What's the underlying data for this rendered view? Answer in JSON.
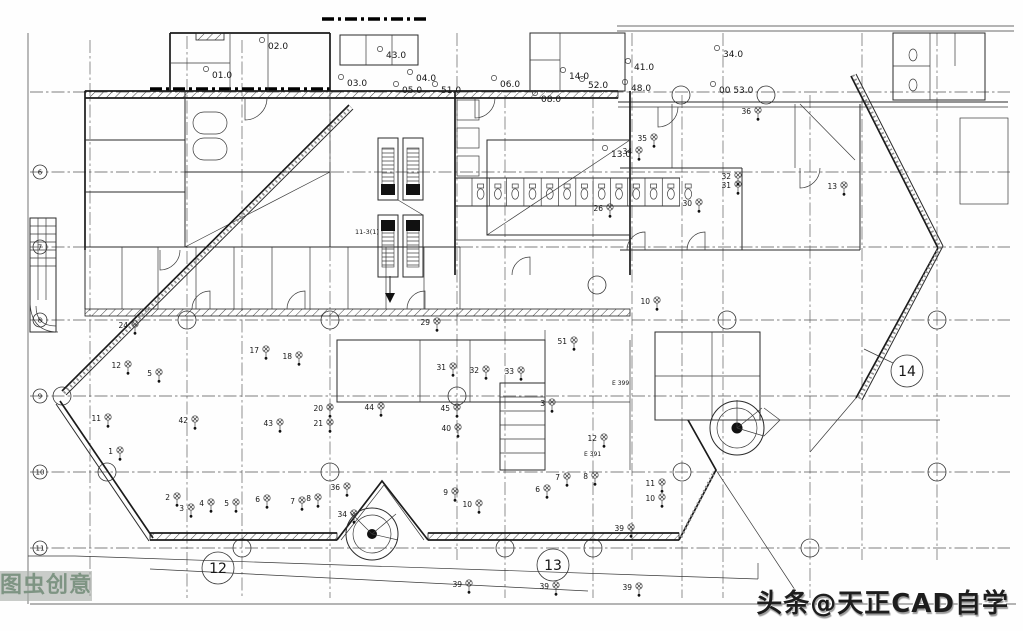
{
  "watermarks": {
    "bottom_left": "图虫创意",
    "bottom_right": "头条@天正CAD自学"
  },
  "colors": {
    "paper": "#fefefe",
    "ink": "#1b1b1b",
    "grid_line": "#555555",
    "watermark_left_bg": "rgba(168,172,168,0.62)",
    "watermark_left_text": "#7e9483",
    "watermark_right_text": "#1d1d1d"
  },
  "drawing": {
    "section_bubbles": [
      {
        "t": "12",
        "x": 218,
        "y": 568
      },
      {
        "t": "13",
        "x": 553,
        "y": 565
      },
      {
        "t": "14",
        "x": 907,
        "y": 371
      }
    ],
    "row_markers": [
      {
        "t": "6",
        "y": 172
      },
      {
        "t": "7",
        "y": 247
      },
      {
        "t": "8",
        "y": 320
      },
      {
        "t": "9",
        "y": 396
      },
      {
        "t": "10",
        "y": 472
      },
      {
        "t": "11",
        "y": 548
      }
    ],
    "room_labels": [
      {
        "t": "01.0",
        "x": 212,
        "y": 78
      },
      {
        "t": "02.0",
        "x": 268,
        "y": 49
      },
      {
        "t": "03.0",
        "x": 347,
        "y": 86
      },
      {
        "t": "43.0",
        "x": 386,
        "y": 58
      },
      {
        "t": "04.0",
        "x": 416,
        "y": 81
      },
      {
        "t": "05.0",
        "x": 402,
        "y": 93
      },
      {
        "t": "51.0",
        "x": 441,
        "y": 93
      },
      {
        "t": "06.0",
        "x": 500,
        "y": 87
      },
      {
        "t": "08.0",
        "x": 541,
        "y": 102
      },
      {
        "t": "14.0",
        "x": 569,
        "y": 79
      },
      {
        "t": "52.0",
        "x": 588,
        "y": 88
      },
      {
        "t": "41.0",
        "x": 634,
        "y": 70
      },
      {
        "t": "48.0",
        "x": 631,
        "y": 91
      },
      {
        "t": "13.0",
        "x": 611,
        "y": 157
      },
      {
        "t": "34.0",
        "x": 723,
        "y": 57
      },
      {
        "t": "00 53.0",
        "x": 719,
        "y": 93
      }
    ],
    "point_labels": [
      {
        "t": "24",
        "x": 128,
        "y": 328
      },
      {
        "t": "12",
        "x": 121,
        "y": 368
      },
      {
        "t": "5",
        "x": 152,
        "y": 376
      },
      {
        "t": "11",
        "x": 101,
        "y": 421
      },
      {
        "t": "1",
        "x": 113,
        "y": 454
      },
      {
        "t": "42",
        "x": 188,
        "y": 423
      },
      {
        "t": "43",
        "x": 273,
        "y": 426
      },
      {
        "t": "17",
        "x": 259,
        "y": 353
      },
      {
        "t": "18",
        "x": 292,
        "y": 359
      },
      {
        "t": "20",
        "x": 323,
        "y": 411
      },
      {
        "t": "21",
        "x": 323,
        "y": 426
      },
      {
        "t": "2",
        "x": 170,
        "y": 500
      },
      {
        "t": "3",
        "x": 184,
        "y": 511
      },
      {
        "t": "4",
        "x": 204,
        "y": 506
      },
      {
        "t": "5",
        "x": 229,
        "y": 506
      },
      {
        "t": "6",
        "x": 260,
        "y": 502
      },
      {
        "t": "7",
        "x": 295,
        "y": 504
      },
      {
        "t": "8",
        "x": 311,
        "y": 501
      },
      {
        "t": "36",
        "x": 340,
        "y": 490
      },
      {
        "t": "34",
        "x": 347,
        "y": 517
      },
      {
        "t": "29",
        "x": 430,
        "y": 325
      },
      {
        "t": "45",
        "x": 450,
        "y": 411
      },
      {
        "t": "40",
        "x": 451,
        "y": 431
      },
      {
        "t": "9",
        "x": 448,
        "y": 495
      },
      {
        "t": "10",
        "x": 472,
        "y": 507
      },
      {
        "t": "31",
        "x": 446,
        "y": 370
      },
      {
        "t": "32",
        "x": 479,
        "y": 373
      },
      {
        "t": "33",
        "x": 514,
        "y": 374
      },
      {
        "t": "3",
        "x": 545,
        "y": 406
      },
      {
        "t": "12",
        "x": 597,
        "y": 441
      },
      {
        "t": "6",
        "x": 540,
        "y": 492
      },
      {
        "t": "7",
        "x": 560,
        "y": 480
      },
      {
        "t": "8",
        "x": 588,
        "y": 479
      },
      {
        "t": "51",
        "x": 567,
        "y": 344
      },
      {
        "t": "26",
        "x": 603,
        "y": 211
      },
      {
        "t": "11",
        "x": 655,
        "y": 486
      },
      {
        "t": "10",
        "x": 655,
        "y": 501
      },
      {
        "t": "39",
        "x": 624,
        "y": 531
      },
      {
        "t": "39",
        "x": 462,
        "y": 587
      },
      {
        "t": "39",
        "x": 549,
        "y": 589
      },
      {
        "t": "39",
        "x": 632,
        "y": 590
      },
      {
        "t": "44",
        "x": 374,
        "y": 410
      },
      {
        "t": "35",
        "x": 647,
        "y": 141
      },
      {
        "t": "34",
        "x": 632,
        "y": 154
      },
      {
        "t": "30",
        "x": 692,
        "y": 206
      },
      {
        "t": "31",
        "x": 731,
        "y": 188
      },
      {
        "t": "32",
        "x": 731,
        "y": 179
      },
      {
        "t": "36",
        "x": 751,
        "y": 114
      },
      {
        "t": "13",
        "x": 837,
        "y": 189
      },
      {
        "t": "10",
        "x": 650,
        "y": 304
      }
    ],
    "room_codes": [
      {
        "t": "E 391",
        "x": 584,
        "y": 456
      },
      {
        "t": "E 399",
        "x": 612,
        "y": 385
      }
    ],
    "annotations": [
      {
        "t": "11-3(1)",
        "x": 355,
        "y": 234
      }
    ]
  }
}
